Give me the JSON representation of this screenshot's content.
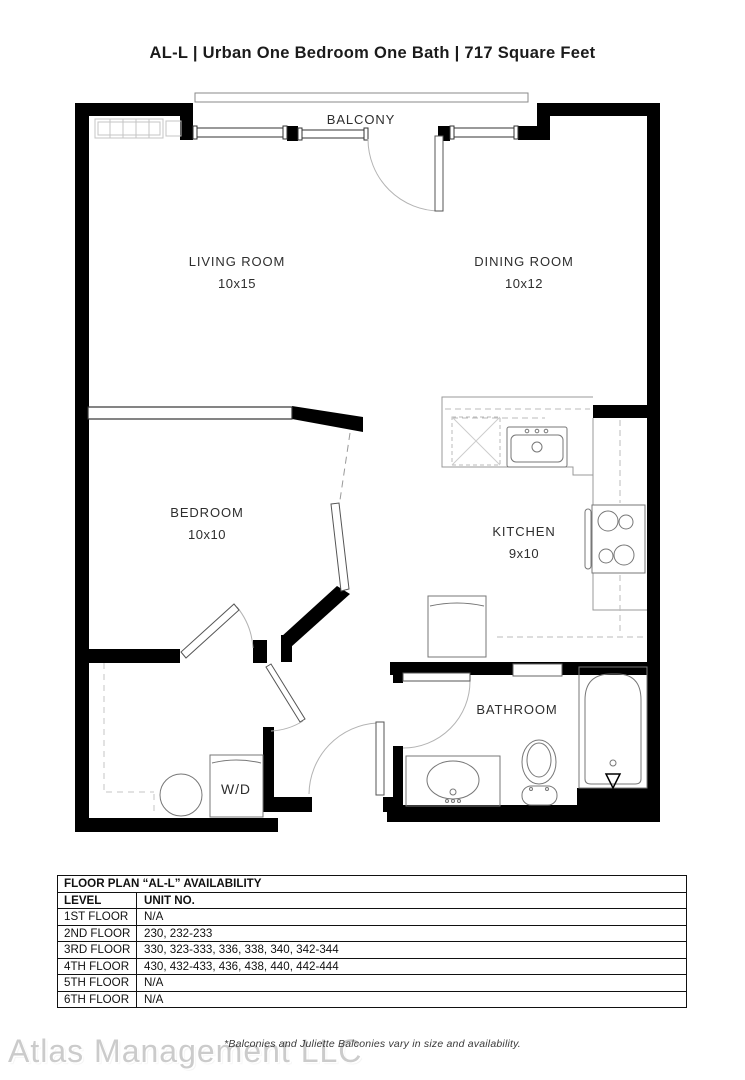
{
  "title": "AL-L | Urban One Bedroom One Bath | 717 Square Feet",
  "plan": {
    "balcony": "BALCONY",
    "living": {
      "name": "LIVING ROOM",
      "dims": "10x15"
    },
    "dining": {
      "name": "DINING ROOM",
      "dims": "10x12"
    },
    "bedroom": {
      "name": "BEDROOM",
      "dims": "10x10"
    },
    "kitchen": {
      "name": "KITCHEN",
      "dims": "9x10"
    },
    "bathroom": {
      "name": "BATHROOM"
    },
    "wd": "W/D"
  },
  "table": {
    "title": "FLOOR PLAN “AL-L” AVAILABILITY",
    "columns": [
      "LEVEL",
      "UNIT NO."
    ],
    "rows": [
      {
        "level": "1ST FLOOR",
        "units": "N/A"
      },
      {
        "level": "2ND FLOOR",
        "units": "230, 232-233"
      },
      {
        "level": "3RD FLOOR",
        "units": "330, 323-333, 336, 338, 340, 342-344"
      },
      {
        "level": "4TH FLOOR",
        "units": "430, 432-433, 436, 438, 440, 442-444"
      },
      {
        "level": "5TH FLOOR",
        "units": "N/A"
      },
      {
        "level": "6TH FLOOR",
        "units": "N/A"
      }
    ]
  },
  "footnote": "*Balconies and Juliette Balconies vary in size and availability.",
  "watermark": "Atlas Management LLC",
  "colors": {
    "wall": "#000000",
    "fixture": "#8c8c8c",
    "arc": "#b3b3b3"
  }
}
